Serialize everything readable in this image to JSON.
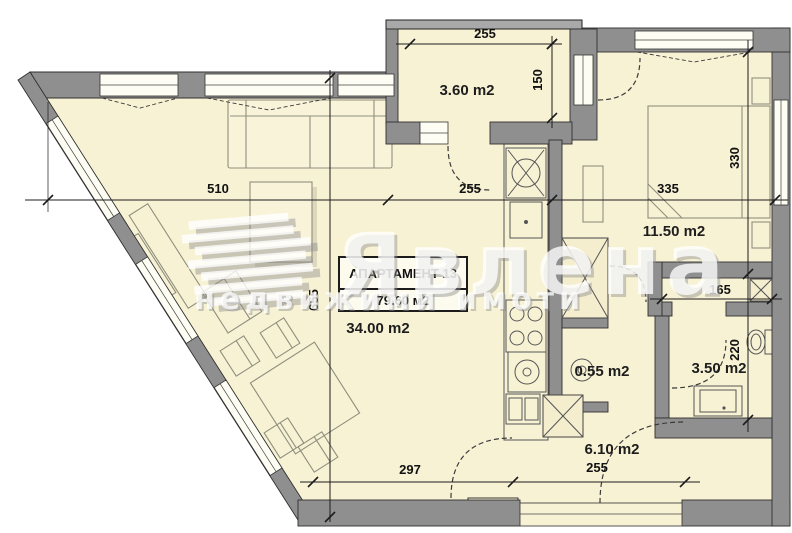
{
  "watermark": {
    "brand": "Явлена",
    "tagline": "недвижими имоти"
  },
  "apartment": {
    "name": "АПАРТАМЕНТ 13",
    "total_area": "79.60 м2"
  },
  "rooms": {
    "living": "34.00 m2",
    "balcony": "3.60 m2",
    "bedroom": "11.50 m2",
    "shaft": "0.55 m2",
    "bathroom": "3.50 m2",
    "hall": "6.10 m2"
  },
  "dims": {
    "balcony_w": "255",
    "balcony_d": "150",
    "living_w": "510",
    "kitchen_w": "255",
    "bedroom_w": "335",
    "living_h": "655",
    "bedroom_h": "330",
    "closet_w": "165",
    "bathroom_h": "220",
    "hall_l": "297",
    "entry_w": "255"
  },
  "colors": {
    "floor": "#f8f2d5",
    "wall": "#8f8f8f",
    "accent_line": "#1c1c1c"
  }
}
